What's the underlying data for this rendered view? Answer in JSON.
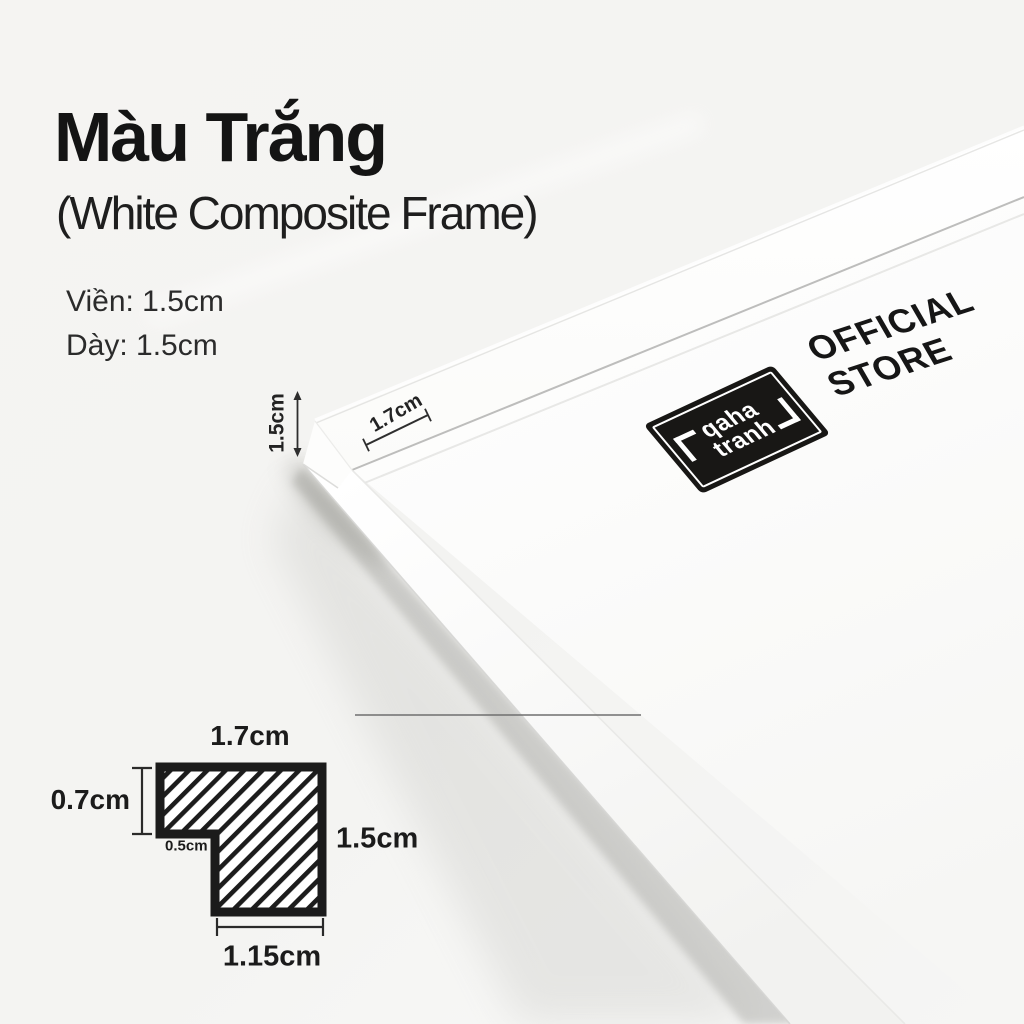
{
  "colors": {
    "background": "#f5f4f2",
    "ink": "#161616",
    "stamp_bg": "#181715",
    "stamp_text": "#ffffff"
  },
  "header": {
    "title": "Màu Trắng",
    "subtitle": "(White Composite Frame)"
  },
  "specs": {
    "line1": "Viền: 1.5cm",
    "line2": "Dày: 1.5cm"
  },
  "photo": {
    "depth_dim": "1.5cm",
    "face_dim": "1.7cm"
  },
  "badge": {
    "brand_top": "qaha",
    "brand_bottom": "tranh",
    "store_top": "OFFICIAL",
    "store_bottom": "STORE"
  },
  "cross_section": {
    "top_width": "1.7cm",
    "left_height": "0.7cm",
    "step_width": "0.5cm",
    "right_height": "1.5cm",
    "bottom_width": "1.15cm"
  }
}
